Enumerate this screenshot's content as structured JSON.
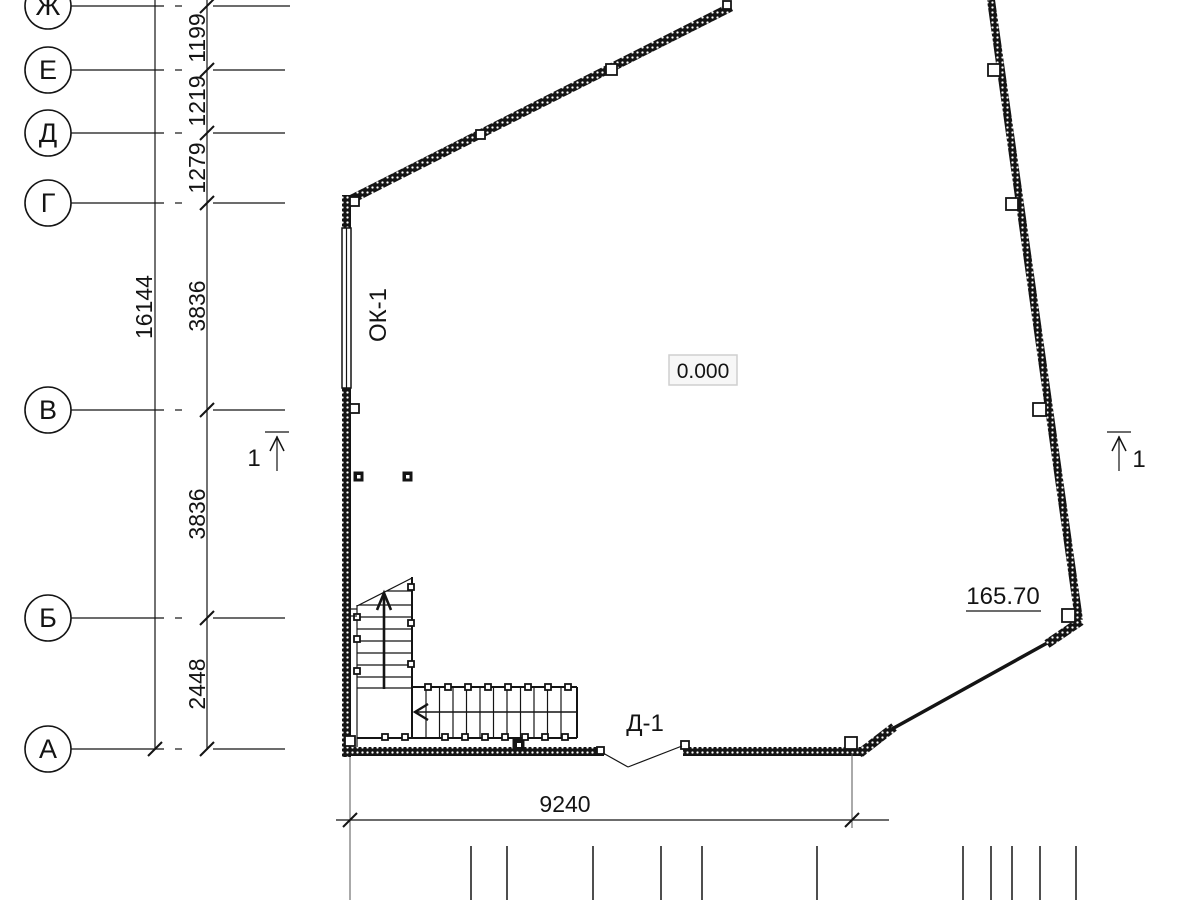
{
  "grid": {
    "rows": [
      {
        "label": "Ж"
      },
      {
        "label": "Е"
      },
      {
        "label": "Д"
      },
      {
        "label": "Г"
      },
      {
        "label": "В"
      },
      {
        "label": "Б"
      },
      {
        "label": "А"
      }
    ]
  },
  "dimensions": {
    "between_zh_e": "1199",
    "between_e_d": "1219",
    "between_d_g": "1279",
    "between_g_v": "3836",
    "between_v_b": "3836",
    "between_b_a": "2448",
    "overall_height": "16144",
    "bottom_width": "9240"
  },
  "marks": {
    "window": "ОК-1",
    "door": "Д-1",
    "floor_level": "0.000",
    "elevation": "165.70",
    "section_cut_left": "1",
    "section_cut_right": "1"
  },
  "colors": {
    "line": "#141414",
    "background": "#ffffff",
    "level_box_bg": "#f7f7f7",
    "level_box_border": "#cfcfcf"
  }
}
